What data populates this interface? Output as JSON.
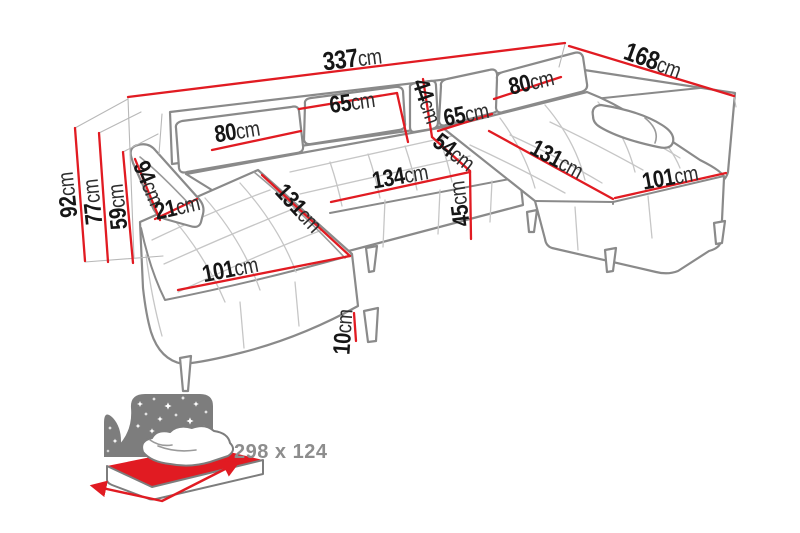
{
  "diagram": {
    "type": "sofa-dimension-diagram",
    "unit": "cm",
    "colors": {
      "dimension_line": "#e11b22",
      "sofa_outline": "#8a8a8a",
      "label_text": "#161616",
      "sleep_icon": "#7d7d7d",
      "sleep_text": "#8d8d8d",
      "background": "#ffffff"
    },
    "dimensions": [
      {
        "id": "overall-width",
        "value": "337",
        "unit": "cm"
      },
      {
        "id": "overall-depth",
        "value": "168",
        "unit": "cm"
      },
      {
        "id": "overall-height",
        "value": "92",
        "unit": "cm"
      },
      {
        "id": "backrest-height",
        "value": "77",
        "unit": "cm"
      },
      {
        "id": "seat-back-height",
        "value": "59",
        "unit": "cm"
      },
      {
        "id": "armrest-length",
        "value": "94",
        "unit": "cm"
      },
      {
        "id": "armrest-width",
        "value": "21",
        "unit": "cm"
      },
      {
        "id": "back-cushion-left",
        "value": "80",
        "unit": "cm"
      },
      {
        "id": "back-cushion-mid-left",
        "value": "65",
        "unit": "cm"
      },
      {
        "id": "corner-back-height",
        "value": "44",
        "unit": "cm"
      },
      {
        "id": "back-cushion-mid-right",
        "value": "65",
        "unit": "cm"
      },
      {
        "id": "back-cushion-right",
        "value": "80",
        "unit": "cm"
      },
      {
        "id": "seat-depth",
        "value": "54",
        "unit": "cm"
      },
      {
        "id": "middle-seat-width",
        "value": "134",
        "unit": "cm"
      },
      {
        "id": "seat-height",
        "value": "45",
        "unit": "cm"
      },
      {
        "id": "chaise-length-left",
        "value": "131",
        "unit": "cm"
      },
      {
        "id": "chaise-length-right",
        "value": "131",
        "unit": "cm"
      },
      {
        "id": "chaise-width-left",
        "value": "101",
        "unit": "cm"
      },
      {
        "id": "chaise-width-right",
        "value": "101",
        "unit": "cm"
      },
      {
        "id": "leg-height",
        "value": "10",
        "unit": "cm"
      }
    ],
    "sleeping_function": {
      "icon": "sleep-function-icon",
      "size_label": "298 x 124"
    }
  }
}
